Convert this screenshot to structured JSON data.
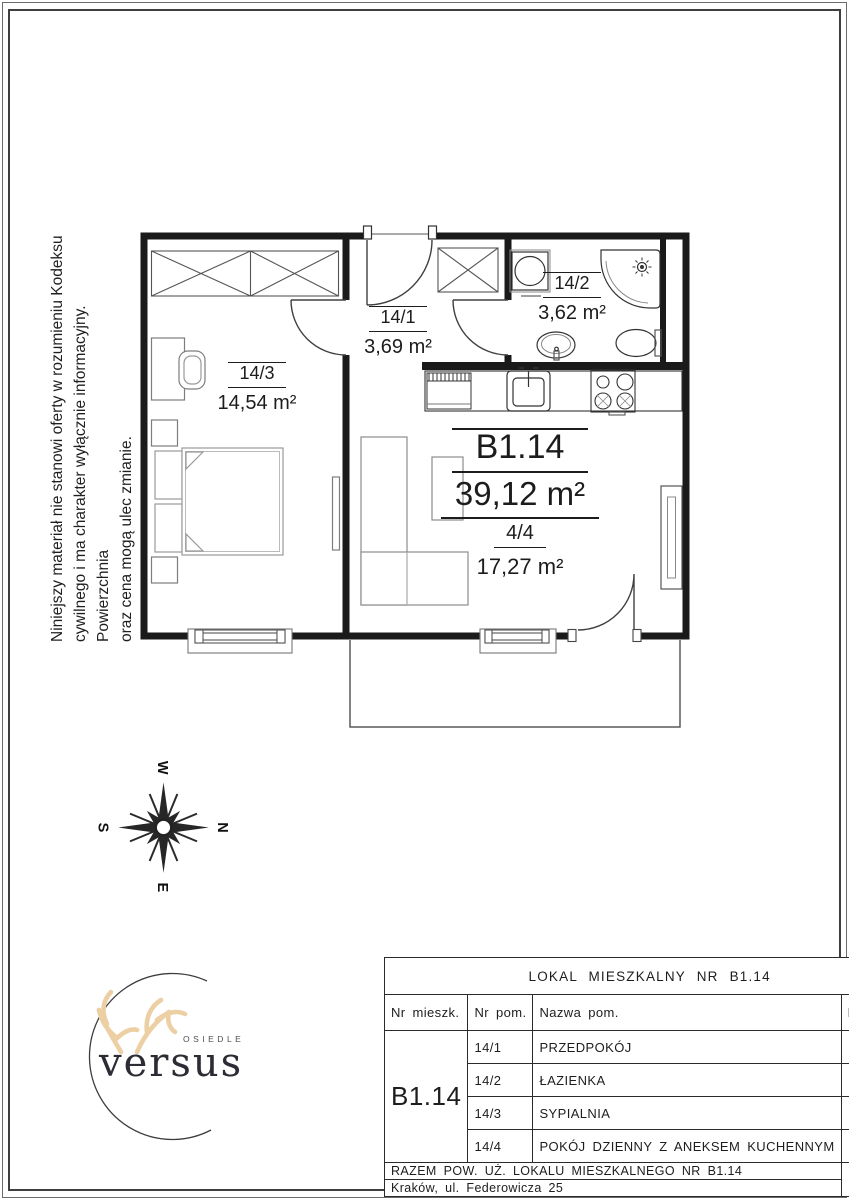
{
  "page": {
    "background": "#ffffff",
    "border_color": "#3f3f3f"
  },
  "disclaimer": {
    "line1": "Niniejszy materiał nie stanowi oferty w rozumieniu Kodeksu",
    "line2": "cywilnego i ma charakter wyłącznie informacyjny. Powierzchnia",
    "line3": "oraz cena mogą ulec zmianie."
  },
  "plan": {
    "bedroom": {
      "id": "14/3",
      "area": "14,54 m²"
    },
    "hall": {
      "id": "14/1",
      "area": "3,69 m²"
    },
    "bath": {
      "id": "14/2",
      "area": "3,62 m²"
    },
    "unit": {
      "id": "B1.14",
      "area": "39,12 m²"
    },
    "living": {
      "id": "4/4",
      "area": "17,27 m²"
    }
  },
  "compass": {
    "n": "N",
    "e": "E",
    "s": "S",
    "w": "W"
  },
  "logo": {
    "estate_word": "OSIEDLE",
    "brand": "versus",
    "antler_color": "#ecd0a4"
  },
  "table": {
    "title": "LOKAL MIESZKALNY NR B1.14",
    "col_unit": "Nr mieszk.",
    "col_no": "Nr pom.",
    "col_name": "Nazwa pom.",
    "col_area": "Pow. [m²]",
    "unit_id": "B1.14",
    "rows": [
      {
        "no": "14/1",
        "name": "PRZEDPOKÓJ",
        "area": "3.69"
      },
      {
        "no": "14/2",
        "name": "ŁAZIENKA",
        "area": "3.62"
      },
      {
        "no": "14/3",
        "name": "SYPIALNIA",
        "area": "14,54"
      },
      {
        "no": "14/4",
        "name": "POKÓJ DZIENNY Z ANEKSEM KUCHENNYM",
        "area": "17.27"
      }
    ],
    "total_label": "RAZEM POW. UŻ. LOKALU MIESZKALNEGO NR B1.14",
    "address": "Kraków, ul. Federowicza 25",
    "total_area": "39.12"
  }
}
